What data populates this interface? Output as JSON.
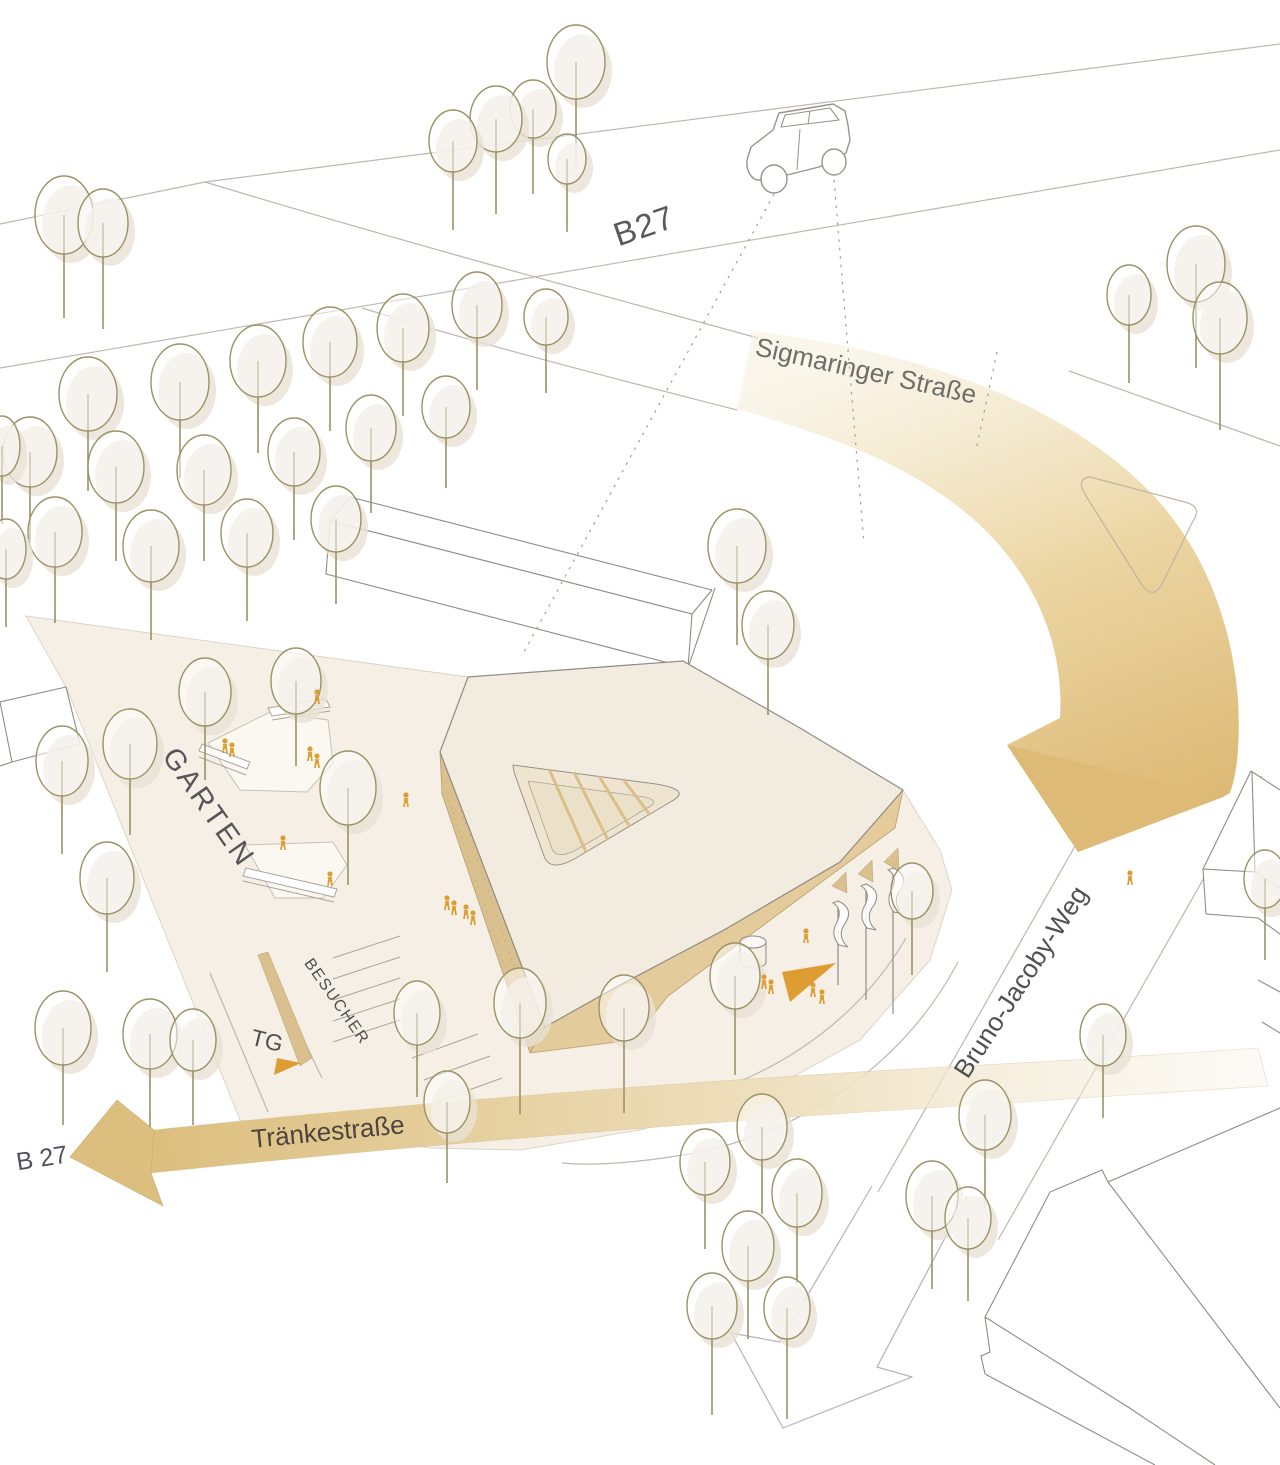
{
  "diagram": {
    "type": "architectural-site-plan-axonometric",
    "labels": {
      "highway_top": "B27",
      "street_top": "Sigmaringer Straße",
      "garden": "GARTEN",
      "garage": "TG",
      "visitor_parking": "BESUCHER",
      "street_bottom": "Tränkestraße",
      "highway_bottom": "B 27",
      "street_right": "Bruno-Jacoby-Weg"
    },
    "colors": {
      "ground": "#f6efe5",
      "roof": "#f2ebdf",
      "wall": "#e4cb9b",
      "wall_dark": "#d9c08e",
      "flow_arrow": "#ddba76",
      "flow_arrow_head": "#dcbe7e",
      "accent_orange": "#dd9d33",
      "tree_stroke": "#9b9265",
      "tree_shadow": "#e8e1d4",
      "road_line": "#bdb7af",
      "building_outline": "#8f8b85",
      "label_gray": "#55555a",
      "label_brown": "#4c443d"
    },
    "trees": [
      [
        64,
        215,
        29,
        39,
        64
      ],
      [
        103,
        223,
        25,
        34,
        72
      ],
      [
        576,
        62,
        29,
        37,
        66
      ],
      [
        533,
        109,
        23,
        29,
        56
      ],
      [
        496,
        119,
        26,
        33,
        62
      ],
      [
        453,
        141,
        24,
        31,
        58
      ],
      [
        567,
        159,
        19,
        25,
        48
      ],
      [
        1129,
        295,
        22,
        30,
        58
      ],
      [
        1196,
        264,
        29,
        38,
        66
      ],
      [
        1220,
        318,
        27,
        36,
        76
      ],
      [
        88,
        394,
        29,
        37,
        60
      ],
      [
        180,
        382,
        29,
        38,
        58
      ],
      [
        258,
        361,
        28,
        36,
        56
      ],
      [
        330,
        342,
        27,
        35,
        54
      ],
      [
        403,
        328,
        26,
        34,
        54
      ],
      [
        477,
        305,
        25,
        33,
        52
      ],
      [
        546,
        317,
        22,
        28,
        48
      ],
      [
        30,
        452,
        27,
        35,
        56
      ],
      [
        116,
        467,
        28,
        36,
        58
      ],
      [
        204,
        470,
        27,
        35,
        56
      ],
      [
        294,
        452,
        26,
        34,
        54
      ],
      [
        371,
        428,
        25,
        33,
        52
      ],
      [
        446,
        407,
        24,
        31,
        50
      ],
      [
        55,
        532,
        27,
        35,
        56
      ],
      [
        151,
        546,
        28,
        36,
        58
      ],
      [
        247,
        533,
        26,
        34,
        54
      ],
      [
        336,
        519,
        25,
        33,
        52
      ],
      [
        2,
        446,
        18,
        30,
        48
      ],
      [
        6,
        549,
        20,
        30,
        48
      ],
      [
        737,
        546,
        29,
        37,
        62
      ],
      [
        768,
        625,
        26,
        34,
        56
      ],
      [
        62,
        761,
        26,
        35,
        58
      ],
      [
        130,
        744,
        27,
        35,
        56
      ],
      [
        205,
        692,
        26,
        34,
        54
      ],
      [
        296,
        681,
        25,
        33,
        52
      ],
      [
        107,
        878,
        27,
        36,
        58
      ],
      [
        63,
        1028,
        28,
        37,
        60
      ],
      [
        150,
        1034,
        27,
        35,
        58
      ],
      [
        193,
        1040,
        23,
        31,
        54
      ],
      [
        348,
        788,
        28,
        37,
        60
      ],
      [
        417,
        1013,
        23,
        32,
        52
      ],
      [
        447,
        1102,
        23,
        31,
        50
      ],
      [
        520,
        1003,
        26,
        35,
        76
      ],
      [
        624,
        1008,
        25,
        33,
        72
      ],
      [
        735,
        976,
        25,
        33,
        66
      ],
      [
        912,
        891,
        21,
        28,
        56
      ],
      [
        985,
        1115,
        26,
        35,
        58
      ],
      [
        1103,
        1035,
        23,
        31,
        52
      ],
      [
        1265,
        879,
        21,
        29,
        52
      ],
      [
        705,
        1162,
        25,
        33,
        54
      ],
      [
        762,
        1127,
        25,
        33,
        54
      ],
      [
        797,
        1193,
        25,
        34,
        56
      ],
      [
        748,
        1246,
        26,
        35,
        58
      ],
      [
        712,
        1306,
        25,
        33,
        76
      ],
      [
        787,
        1308,
        23,
        31,
        80
      ],
      [
        932,
        1196,
        26,
        35,
        58
      ],
      [
        968,
        1218,
        23,
        31,
        52
      ]
    ],
    "people": [
      [
        317,
        704
      ],
      [
        310,
        761
      ],
      [
        317,
        768
      ],
      [
        225,
        753
      ],
      [
        232,
        757
      ],
      [
        283,
        850
      ],
      [
        330,
        886
      ],
      [
        406,
        807
      ],
      [
        447,
        910
      ],
      [
        454,
        915
      ],
      [
        466,
        919
      ],
      [
        473,
        925
      ],
      [
        806,
        943
      ],
      [
        764,
        989
      ],
      [
        771,
        994
      ],
      [
        813,
        997
      ],
      [
        822,
        1004
      ],
      [
        1130,
        885
      ]
    ],
    "flags": [
      {
        "x": 838,
        "y": 901,
        "pole": 84
      },
      {
        "x": 866,
        "y": 884,
        "pole": 116
      },
      {
        "x": 893,
        "y": 868,
        "pole": 146
      }
    ],
    "parking_lines": [
      [
        333,
        958,
        400,
        936
      ],
      [
        333,
        979,
        400,
        957
      ],
      [
        333,
        1000,
        400,
        978
      ],
      [
        333,
        1021,
        400,
        999
      ],
      [
        333,
        1042,
        400,
        1020
      ],
      [
        412,
        1058,
        478,
        1034
      ],
      [
        424,
        1080,
        490,
        1056
      ],
      [
        436,
        1102,
        502,
        1078
      ]
    ]
  }
}
